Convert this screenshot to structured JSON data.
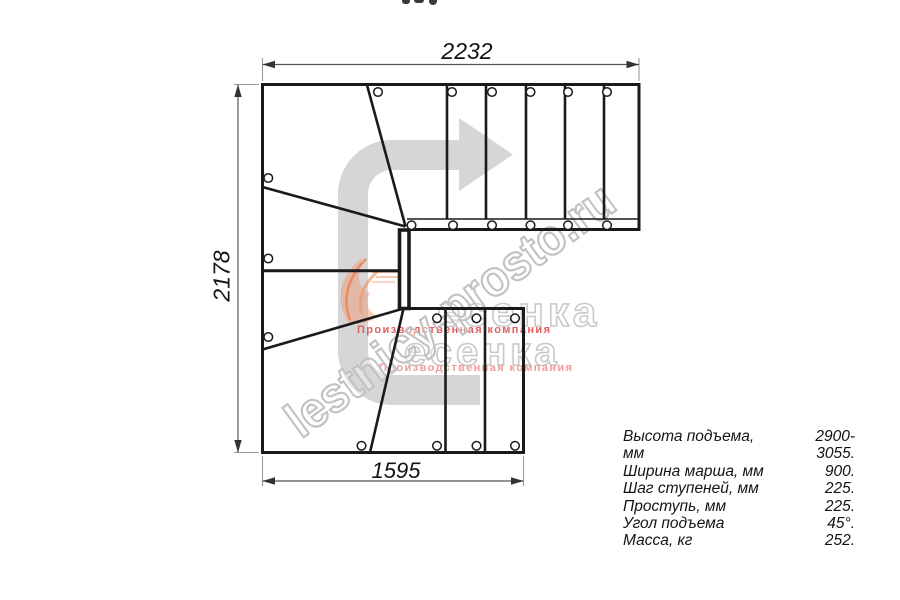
{
  "drawing": {
    "dim_top": "2232",
    "dim_left": "2178",
    "dim_bottom": "1595",
    "direction_arrow": "u-turn-right-arrow"
  },
  "specs": {
    "rows": [
      {
        "label": "Высота подъема, мм",
        "value": "2900-3055."
      },
      {
        "label": "Ширина марша, мм",
        "value": "900."
      },
      {
        "label": "Шаг ступеней, мм",
        "value": "225."
      },
      {
        "label": "Проступь, мм",
        "value": "225."
      },
      {
        "label": "Угол подъема",
        "value": "45°."
      },
      {
        "label": "Масса, кг",
        "value": "252."
      }
    ]
  },
  "watermark": {
    "url_text": "lestnicy-prosto.ru",
    "logo_text": "есенка",
    "logo_subtext": "Производственная компания"
  },
  "colors": {
    "line": "#1a1a1a",
    "dimension": "#555555",
    "extension": "#9a9a9a",
    "arrow_gray": "#d6d6d6",
    "watermark_outline": "#c2c2c2",
    "logo_red": "#e05f5f",
    "logo_orange": "#ef6a30"
  }
}
